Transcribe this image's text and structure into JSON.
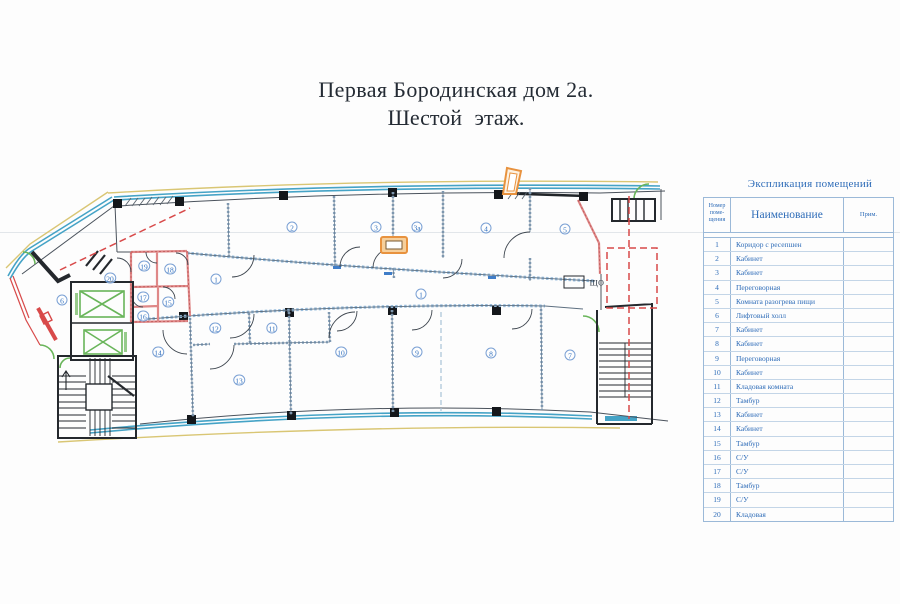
{
  "title": {
    "line1": "Первая Бородинская дом 2а.",
    "line2": "Шестой  этаж."
  },
  "plan": {
    "shield_label": "ЩО",
    "colors": {
      "teal": "#45a3c6",
      "yellow": "#d9c674",
      "red": "#d84a4a",
      "pink": "#df8888",
      "green": "#69b55a",
      "orange": "#e8923e",
      "label_blue": "#2f6fbe"
    },
    "rooms": [
      {
        "n": "1",
        "x": 216,
        "y": 279
      },
      {
        "n": "1",
        "x": 421,
        "y": 294
      },
      {
        "n": "2",
        "x": 292,
        "y": 227
      },
      {
        "n": "3",
        "x": 376,
        "y": 227
      },
      {
        "n": "3а",
        "x": 417,
        "y": 227
      },
      {
        "n": "4",
        "x": 486,
        "y": 228
      },
      {
        "n": "5",
        "x": 565,
        "y": 229
      },
      {
        "n": "6",
        "x": 62,
        "y": 300
      },
      {
        "n": "7",
        "x": 570,
        "y": 355
      },
      {
        "n": "8",
        "x": 491,
        "y": 353
      },
      {
        "n": "9",
        "x": 417,
        "y": 352
      },
      {
        "n": "10",
        "x": 341,
        "y": 352
      },
      {
        "n": "11",
        "x": 272,
        "y": 328
      },
      {
        "n": "12",
        "x": 215,
        "y": 328
      },
      {
        "n": "13",
        "x": 239,
        "y": 380
      },
      {
        "n": "14",
        "x": 158,
        "y": 352
      },
      {
        "n": "15",
        "x": 168,
        "y": 302
      },
      {
        "n": "16",
        "x": 143,
        "y": 316
      },
      {
        "n": "17",
        "x": 143,
        "y": 297
      },
      {
        "n": "18",
        "x": 170,
        "y": 269
      },
      {
        "n": "19",
        "x": 144,
        "y": 266
      },
      {
        "n": "20",
        "x": 110,
        "y": 278
      }
    ]
  },
  "table": {
    "title": "Экспликация помещений",
    "columns": {
      "num": "Номер поме- щения",
      "name": "Наименование",
      "note": "Прим."
    },
    "rows": [
      {
        "num": "1",
        "name": "Коридор с ресепшен",
        "note": ""
      },
      {
        "num": "2",
        "name": "Кабинет",
        "note": ""
      },
      {
        "num": "3",
        "name": "Кабинет",
        "note": ""
      },
      {
        "num": "4",
        "name": "Переговорная",
        "note": ""
      },
      {
        "num": "5",
        "name": "Комната разогрева пищи",
        "note": ""
      },
      {
        "num": "6",
        "name": "Лифтовый холл",
        "note": ""
      },
      {
        "num": "7",
        "name": "Кабинет",
        "note": ""
      },
      {
        "num": "8",
        "name": "Кабинет",
        "note": ""
      },
      {
        "num": "9",
        "name": "Переговорная",
        "note": ""
      },
      {
        "num": "10",
        "name": "Кабинет",
        "note": ""
      },
      {
        "num": "11",
        "name": "Кладовая комната",
        "note": ""
      },
      {
        "num": "12",
        "name": "Тамбур",
        "note": ""
      },
      {
        "num": "13",
        "name": "Кабинет",
        "note": ""
      },
      {
        "num": "14",
        "name": "Кабинет",
        "note": ""
      },
      {
        "num": "15",
        "name": "Тамбур",
        "note": ""
      },
      {
        "num": "16",
        "name": "С/У",
        "note": ""
      },
      {
        "num": "17",
        "name": "С/У",
        "note": ""
      },
      {
        "num": "18",
        "name": "Тамбур",
        "note": ""
      },
      {
        "num": "19",
        "name": "С/У",
        "note": ""
      },
      {
        "num": "20",
        "name": "Кладовая",
        "note": ""
      }
    ]
  }
}
